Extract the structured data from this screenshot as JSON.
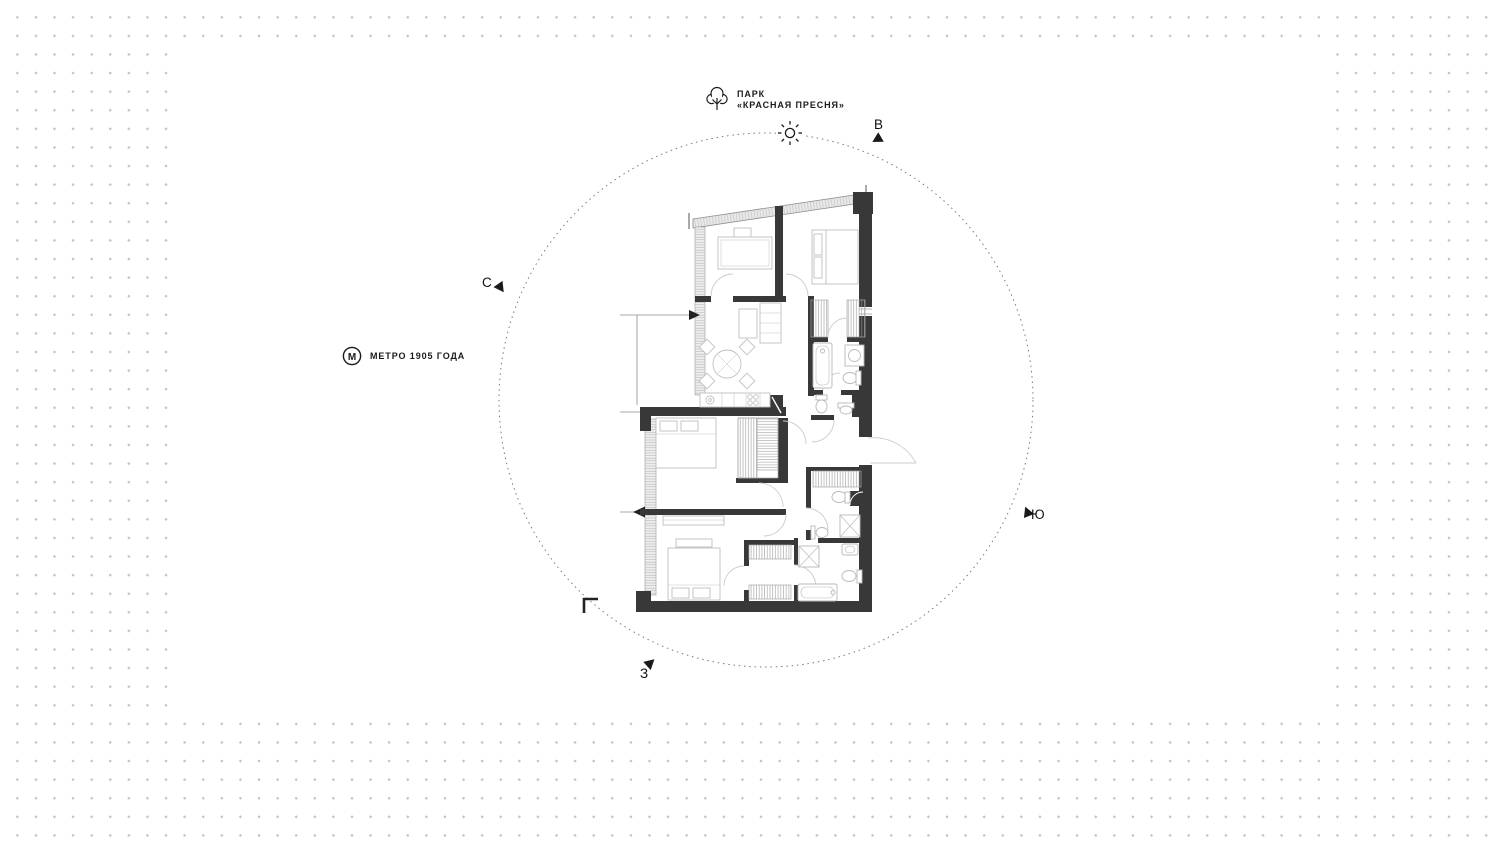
{
  "map": {
    "park": {
      "line1": "ПАРК",
      "line2": "«КРАСНАЯ ПРЕСНЯ»"
    },
    "metro": {
      "icon_letter": "М",
      "label": "МЕТРО 1905 ГОДА"
    },
    "compass": {
      "north": "С",
      "east": "В",
      "south": "Ю",
      "west": "З"
    }
  },
  "colors": {
    "wall": "#383838",
    "dots": "#c4c4c4",
    "line": "#1a1a1a",
    "furniture": "#c0c0c0",
    "glazing": "#e9e9e9"
  }
}
